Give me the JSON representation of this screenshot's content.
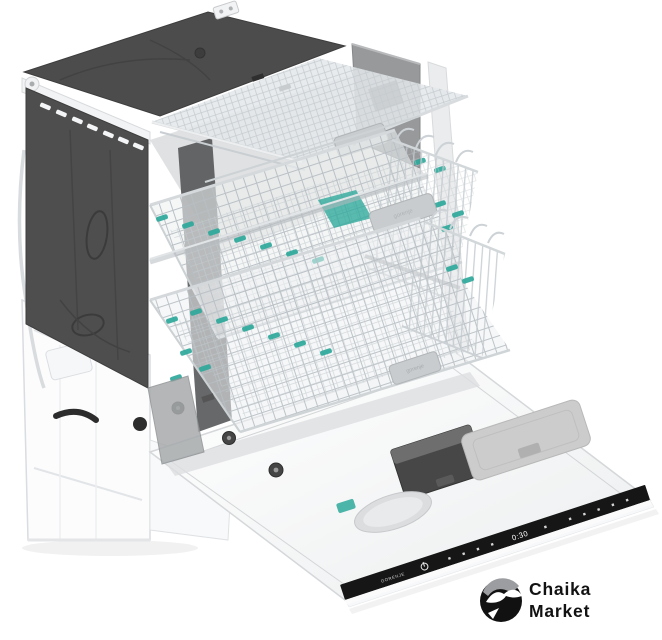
{
  "image": {
    "kind": "product-photo",
    "alt": "Built-in dishwasher cutaway view with three pulled-out wire baskets, teal folding clips, dark insulation wrap and opened front door with integrated top-edge control strip"
  },
  "appliance": {
    "handle_brand": "gorenje"
  },
  "control_strip": {
    "brand_label": "GORENJE",
    "display_value": "0:30"
  },
  "logo": {
    "line1": "Chaika",
    "line2": "Market"
  },
  "icons": {
    "power": "power-icon",
    "seagull": "seagull-icon",
    "program_markers": "program-dot-icons"
  },
  "colors": {
    "background": "#ffffff",
    "cabinet_dark": "#4d4c4c",
    "side_panel_dark": "#4f4e4e",
    "back_panel_gray": "#97999b",
    "rack_wire_gray": "#c6ccd0",
    "accent_teal": "#2ea99b",
    "control_strip_black": "#161616",
    "logo_black": "#111111"
  }
}
